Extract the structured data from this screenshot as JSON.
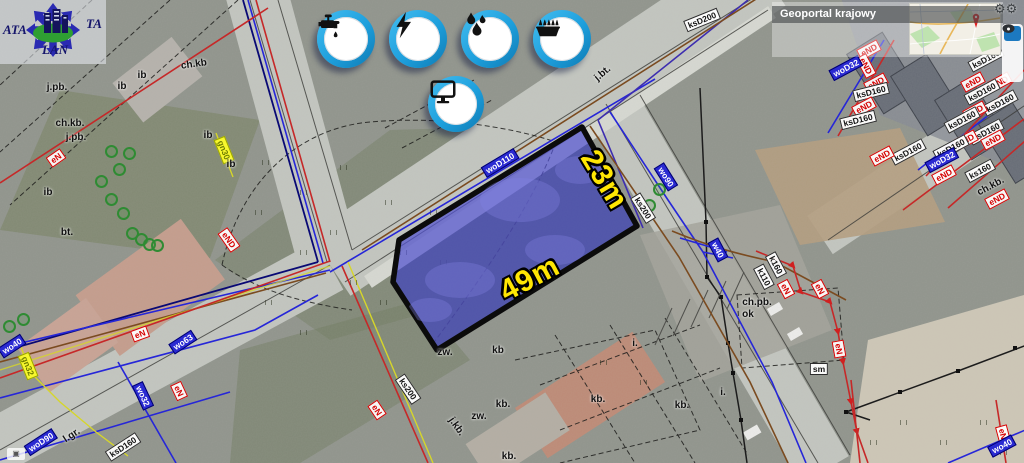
{
  "geoportal": {
    "title": "Geoportal krajowy",
    "marker_icon": "red-map-pin"
  },
  "logo": {
    "text_left": "ATA",
    "text_right": "TA",
    "text_bottom": "LAN"
  },
  "utility_icons": [
    {
      "name": "water-tap-icon"
    },
    {
      "name": "electricity-bolt-icon"
    },
    {
      "name": "water-drops-icon"
    },
    {
      "name": "gas-burner-icon"
    },
    {
      "name": "internet-monitor-icon"
    }
  ],
  "plot": {
    "side_label": "23m",
    "bottom_label": "49m",
    "fill_color": "#5353cf",
    "dim_color": "#ffe603"
  },
  "controls": {
    "gear_glyph": "⚙⚙",
    "attr_glyph": "▣"
  },
  "map": {
    "labels": [
      {
        "t": "woD110",
        "x": 500,
        "y": 163,
        "r": -31,
        "s": "wo"
      },
      {
        "t": "wo90",
        "x": 666,
        "y": 177,
        "r": 58,
        "s": "wo"
      },
      {
        "t": "ks200",
        "x": 643,
        "y": 208,
        "r": 58,
        "s": "ks"
      },
      {
        "t": "ksD200",
        "x": 702,
        "y": 20,
        "r": -22,
        "s": "ks"
      },
      {
        "t": "j.bt.",
        "x": 603,
        "y": 74,
        "r": -40,
        "s": "plain"
      },
      {
        "t": "ch.kb",
        "x": 194,
        "y": 65,
        "r": -8,
        "s": "plain"
      },
      {
        "t": "j.pb.",
        "x": 57,
        "y": 88,
        "r": 0,
        "s": "plain"
      },
      {
        "t": "ch.kb.",
        "x": 70,
        "y": 124,
        "r": 0,
        "s": "plain"
      },
      {
        "t": "j.pb.",
        "x": 76,
        "y": 138,
        "r": 0,
        "s": "plain"
      },
      {
        "t": "eN",
        "x": 56,
        "y": 158,
        "r": -35,
        "s": "en"
      },
      {
        "t": "ib",
        "x": 48,
        "y": 193,
        "r": 0,
        "s": "plain"
      },
      {
        "t": "ib",
        "x": 122,
        "y": 87,
        "r": 0,
        "s": "plain"
      },
      {
        "t": "ib",
        "x": 142,
        "y": 76,
        "r": 0,
        "s": "plain"
      },
      {
        "t": "bt.",
        "x": 67,
        "y": 233,
        "r": 0,
        "s": "plain"
      },
      {
        "t": "ib",
        "x": 208,
        "y": 136,
        "r": 0,
        "s": "plain"
      },
      {
        "t": "gn30",
        "x": 224,
        "y": 150,
        "r": 68,
        "s": "gn"
      },
      {
        "t": "ib",
        "x": 231,
        "y": 165,
        "r": 0,
        "s": "plain"
      },
      {
        "t": "eND",
        "x": 229,
        "y": 240,
        "r": 55,
        "s": "en"
      },
      {
        "t": "wo40",
        "x": 12,
        "y": 346,
        "r": -33,
        "s": "wo"
      },
      {
        "t": "gn32",
        "x": 28,
        "y": 366,
        "r": 68,
        "s": "gn"
      },
      {
        "t": "eN",
        "x": 140,
        "y": 334,
        "r": -20,
        "s": "en"
      },
      {
        "t": "wo63",
        "x": 183,
        "y": 342,
        "r": -33,
        "s": "wo"
      },
      {
        "t": "wo32",
        "x": 143,
        "y": 396,
        "r": 65,
        "s": "wo"
      },
      {
        "t": "eN",
        "x": 179,
        "y": 391,
        "r": 65,
        "s": "en"
      },
      {
        "t": "woD90",
        "x": 41,
        "y": 442,
        "r": -33,
        "s": "wo"
      },
      {
        "t": "l.gr.",
        "x": 72,
        "y": 436,
        "r": -33,
        "s": "plain"
      },
      {
        "t": "ksD160",
        "x": 123,
        "y": 447,
        "r": -33,
        "s": "ks"
      },
      {
        "t": "ks200",
        "x": 408,
        "y": 389,
        "r": 56,
        "s": "ks"
      },
      {
        "t": "eN",
        "x": 377,
        "y": 410,
        "r": 56,
        "s": "en"
      },
      {
        "t": "zw.",
        "x": 445,
        "y": 353,
        "r": 0,
        "s": "plain"
      },
      {
        "t": "kb",
        "x": 498,
        "y": 351,
        "r": 0,
        "s": "plain"
      },
      {
        "t": "kb.",
        "x": 503,
        "y": 405,
        "r": 0,
        "s": "plain"
      },
      {
        "t": "zw.",
        "x": 479,
        "y": 417,
        "r": 0,
        "s": "plain"
      },
      {
        "t": "j.kb.",
        "x": 456,
        "y": 427,
        "r": 55,
        "s": "plain"
      },
      {
        "t": "kb.",
        "x": 598,
        "y": 400,
        "r": 0,
        "s": "plain"
      },
      {
        "t": "kb.",
        "x": 682,
        "y": 406,
        "r": 0,
        "s": "plain"
      },
      {
        "t": "kb.",
        "x": 509,
        "y": 457,
        "r": 0,
        "s": "plain"
      },
      {
        "t": "i.",
        "x": 635,
        "y": 344,
        "r": 0,
        "s": "plain"
      },
      {
        "t": "i.",
        "x": 723,
        "y": 393,
        "r": 0,
        "s": "plain"
      },
      {
        "t": "w40",
        "x": 718,
        "y": 250,
        "r": 62,
        "s": "wo"
      },
      {
        "t": "k110",
        "x": 764,
        "y": 277,
        "r": 62,
        "s": "ks"
      },
      {
        "t": "k160",
        "x": 776,
        "y": 265,
        "r": 62,
        "s": "ks"
      },
      {
        "t": "eN",
        "x": 786,
        "y": 289,
        "r": 62,
        "s": "en"
      },
      {
        "t": "eN",
        "x": 820,
        "y": 289,
        "r": 62,
        "s": "en"
      },
      {
        "t": "ch.pb.",
        "x": 757,
        "y": 303,
        "r": 0,
        "s": "plain"
      },
      {
        "t": "ok",
        "x": 748,
        "y": 315,
        "r": 0,
        "s": "plain"
      },
      {
        "t": "eN",
        "x": 839,
        "y": 349,
        "r": 80,
        "s": "en"
      },
      {
        "t": "sm",
        "x": 819,
        "y": 369,
        "r": 0,
        "s": "ks"
      },
      {
        "t": "eN",
        "x": 1003,
        "y": 434,
        "r": 75,
        "s": "en"
      },
      {
        "t": "wo40",
        "x": 1002,
        "y": 446,
        "r": -28,
        "s": "wo"
      },
      {
        "t": "eND",
        "x": 869,
        "y": 50,
        "r": -28,
        "s": "en"
      },
      {
        "t": "eND",
        "x": 866,
        "y": 66,
        "r": 62,
        "s": "en"
      },
      {
        "t": "woD32",
        "x": 846,
        "y": 68,
        "r": -28,
        "s": "wo"
      },
      {
        "t": "eND",
        "x": 876,
        "y": 83,
        "r": -28,
        "s": "en"
      },
      {
        "t": "ksD160",
        "x": 871,
        "y": 92,
        "r": -14,
        "s": "ks"
      },
      {
        "t": "eND",
        "x": 864,
        "y": 107,
        "r": -28,
        "s": "en"
      },
      {
        "t": "ksD160",
        "x": 858,
        "y": 120,
        "r": -14,
        "s": "ks"
      },
      {
        "t": "ksD160",
        "x": 986,
        "y": 59,
        "r": -28,
        "s": "ks"
      },
      {
        "t": "eND",
        "x": 973,
        "y": 82,
        "r": -28,
        "s": "en"
      },
      {
        "t": "eND",
        "x": 1000,
        "y": 82,
        "r": -28,
        "s": "en"
      },
      {
        "t": "ksD160",
        "x": 982,
        "y": 92,
        "r": -28,
        "s": "ks"
      },
      {
        "t": "ksD160",
        "x": 1000,
        "y": 103,
        "r": -28,
        "s": "ks"
      },
      {
        "t": "eND",
        "x": 975,
        "y": 111,
        "r": -28,
        "s": "en"
      },
      {
        "t": "ksD160",
        "x": 962,
        "y": 120,
        "r": -28,
        "s": "ks"
      },
      {
        "t": "ksD160",
        "x": 986,
        "y": 132,
        "r": -28,
        "s": "ks"
      },
      {
        "t": "eND",
        "x": 966,
        "y": 140,
        "r": -28,
        "s": "en"
      },
      {
        "t": "eND",
        "x": 993,
        "y": 140,
        "r": -28,
        "s": "en"
      },
      {
        "t": "ksD160",
        "x": 951,
        "y": 148,
        "r": -28,
        "s": "ks"
      },
      {
        "t": "ksD160",
        "x": 908,
        "y": 152,
        "r": -28,
        "s": "ks"
      },
      {
        "t": "woD32",
        "x": 942,
        "y": 160,
        "r": -28,
        "s": "wo"
      },
      {
        "t": "eND",
        "x": 882,
        "y": 156,
        "r": -28,
        "s": "en"
      },
      {
        "t": "ks160",
        "x": 980,
        "y": 171,
        "r": -28,
        "s": "ks"
      },
      {
        "t": "eND",
        "x": 944,
        "y": 175,
        "r": -28,
        "s": "en"
      },
      {
        "t": "ch.kb.",
        "x": 991,
        "y": 187,
        "r": -28,
        "s": "plain"
      },
      {
        "t": "eND",
        "x": 997,
        "y": 199,
        "r": -28,
        "s": "en"
      }
    ],
    "trees": [
      [
        110,
        150
      ],
      [
        118,
        168
      ],
      [
        110,
        198
      ],
      [
        122,
        212
      ],
      [
        131,
        232
      ],
      [
        140,
        238
      ],
      [
        148,
        243
      ],
      [
        156,
        244
      ],
      [
        100,
        180
      ],
      [
        128,
        152
      ],
      [
        8,
        325
      ],
      [
        22,
        318
      ],
      [
        658,
        188
      ],
      [
        648,
        204
      ]
    ]
  }
}
